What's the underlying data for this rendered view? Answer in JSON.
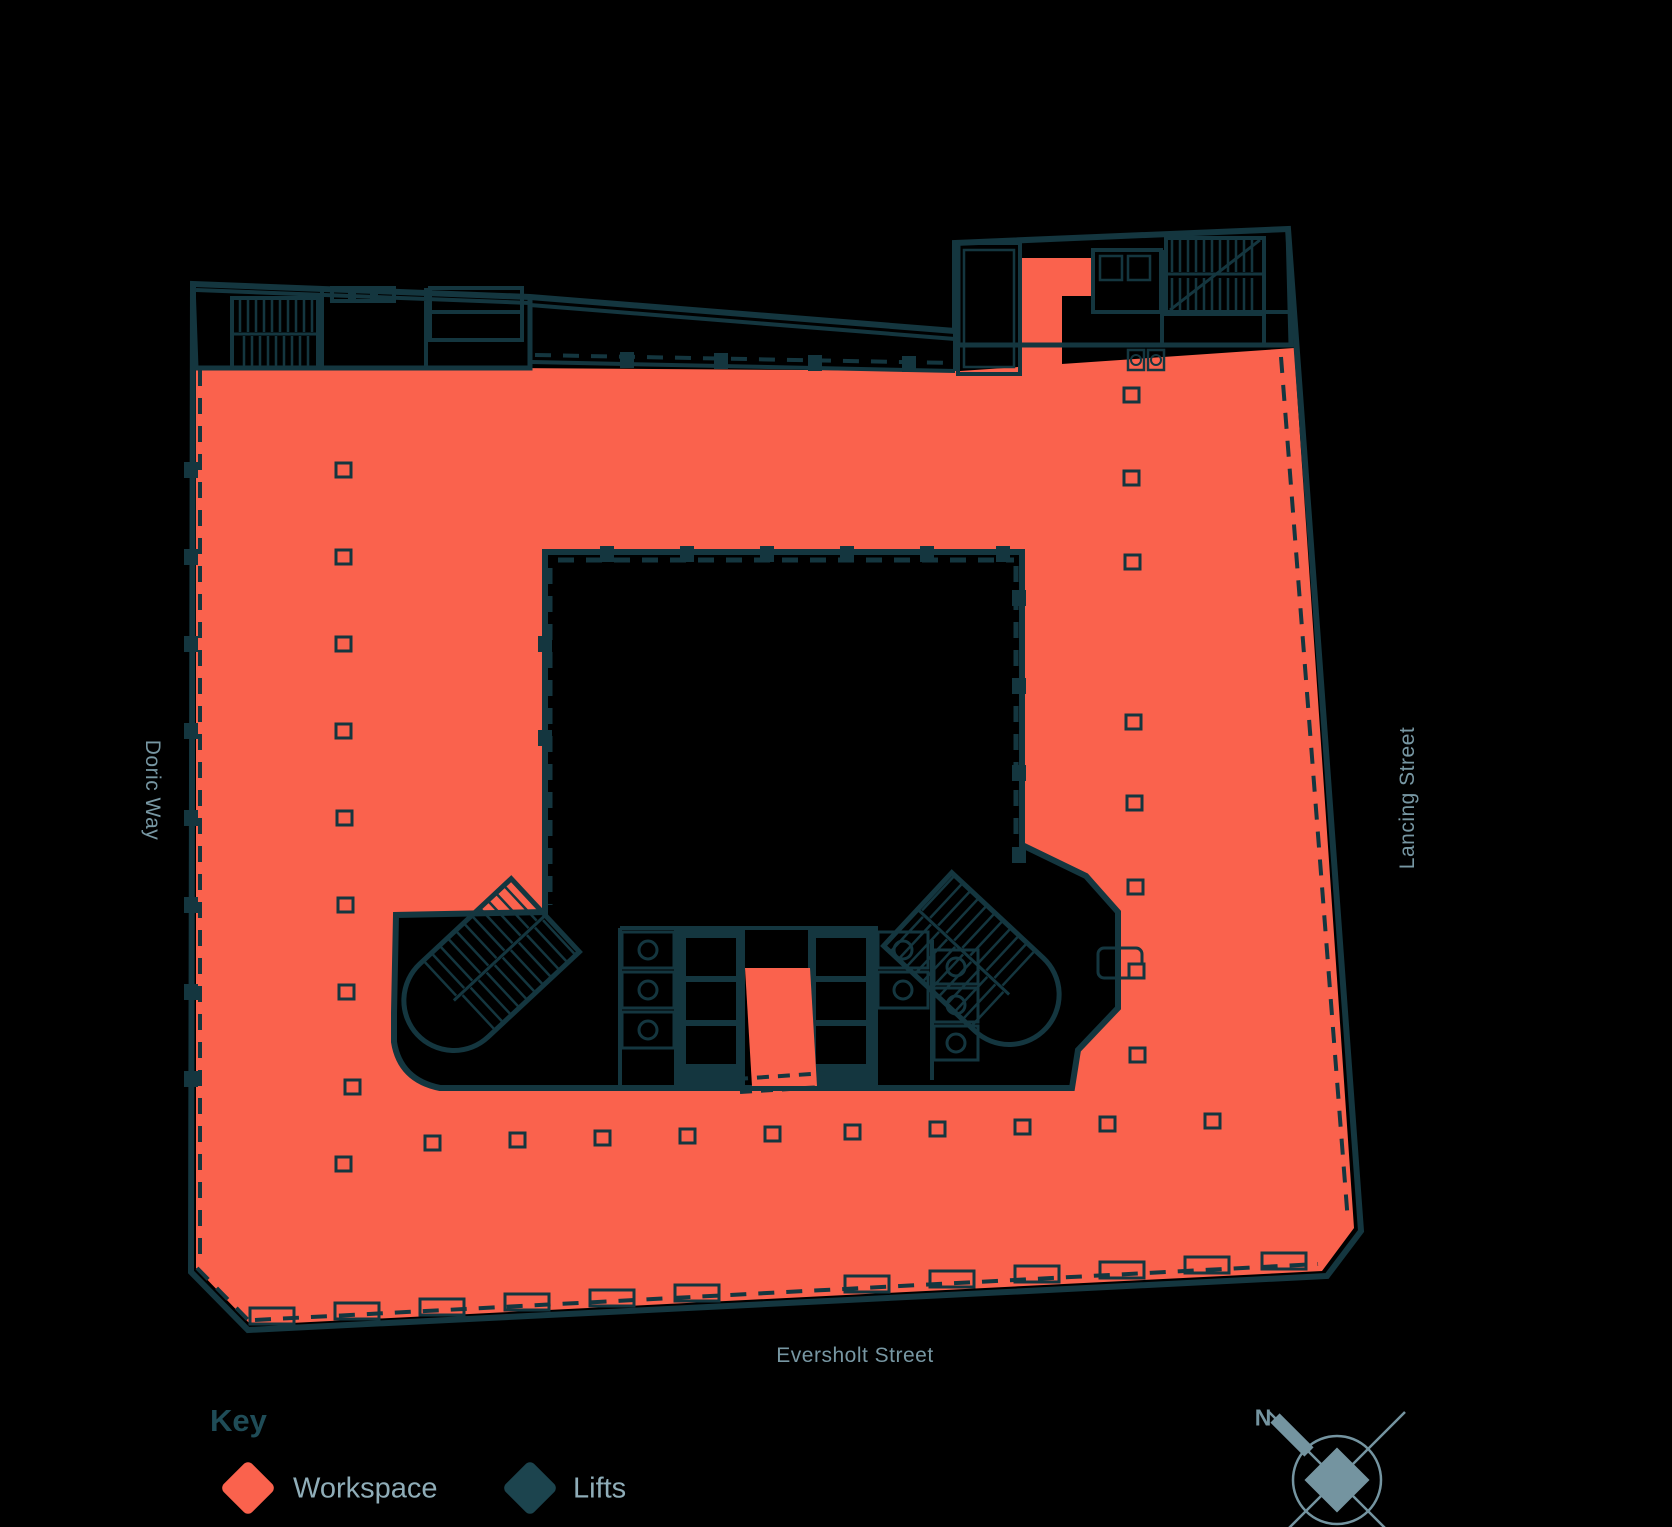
{
  "page": {
    "background": "#000000",
    "kind": "floor-plan"
  },
  "streets": {
    "left": "Doric Way",
    "right": "Lancing Street",
    "bottom": "Eversholt Street"
  },
  "legend": {
    "heading": "Key",
    "items": [
      {
        "id": "workspace",
        "label": "Workspace",
        "color": "#fa624d"
      },
      {
        "id": "lifts",
        "label": "Lifts",
        "color": "#1c444e"
      }
    ]
  },
  "compass": {
    "north_label": "N"
  },
  "colors": {
    "bg": "#000000",
    "workspace": "#fa624d",
    "wall": "#14363f",
    "lifts": "#1c444e",
    "heading": "#1f4c57",
    "label": "#8fadb8",
    "street": "#7797a3",
    "compass": "#7494a0"
  }
}
